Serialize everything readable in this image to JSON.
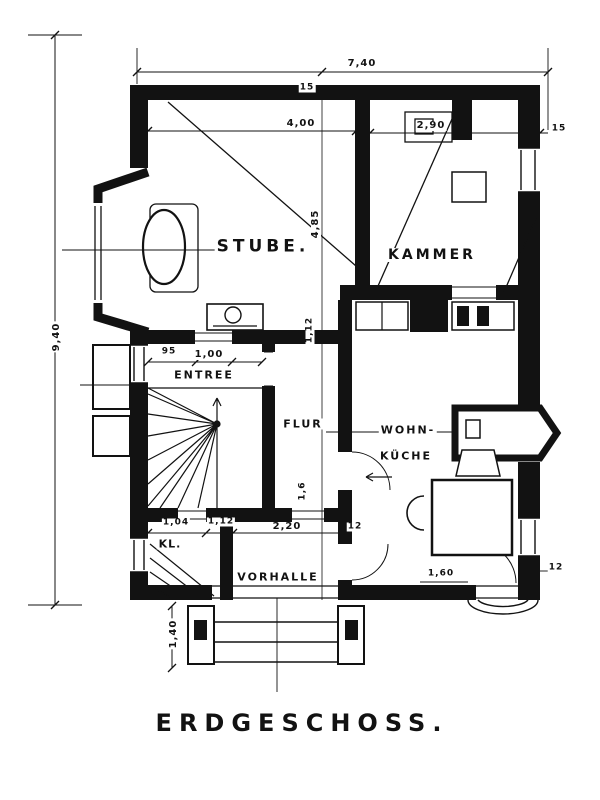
{
  "title": "ERDGESCHOSS.",
  "rooms": {
    "stube": "STUBE.",
    "kammer": "KAMMER",
    "entree": "ENTREE",
    "flur": "FLUR",
    "wohn_line1": "WOHN-",
    "wohn_line2": "KÜCHE",
    "kl": "KL.",
    "vorhalle": "VORHALLE"
  },
  "dims": {
    "width_total": "7,40",
    "height_total": "9,40",
    "stube_w": "4,00",
    "stube_h": "4,85",
    "kammer_w": "2,90",
    "wall15_top": "15",
    "wall15_right": "15",
    "door95": "95",
    "entree_w": "1,00",
    "mid_v": "1,12",
    "flur_v": "1,6",
    "kl_w": "1,04",
    "door112": "1,12",
    "vorhalle_w": "2,20",
    "wall12_bottom": "12",
    "steps_h": "1,40",
    "door160": "1,60",
    "wall12_right": "12"
  }
}
